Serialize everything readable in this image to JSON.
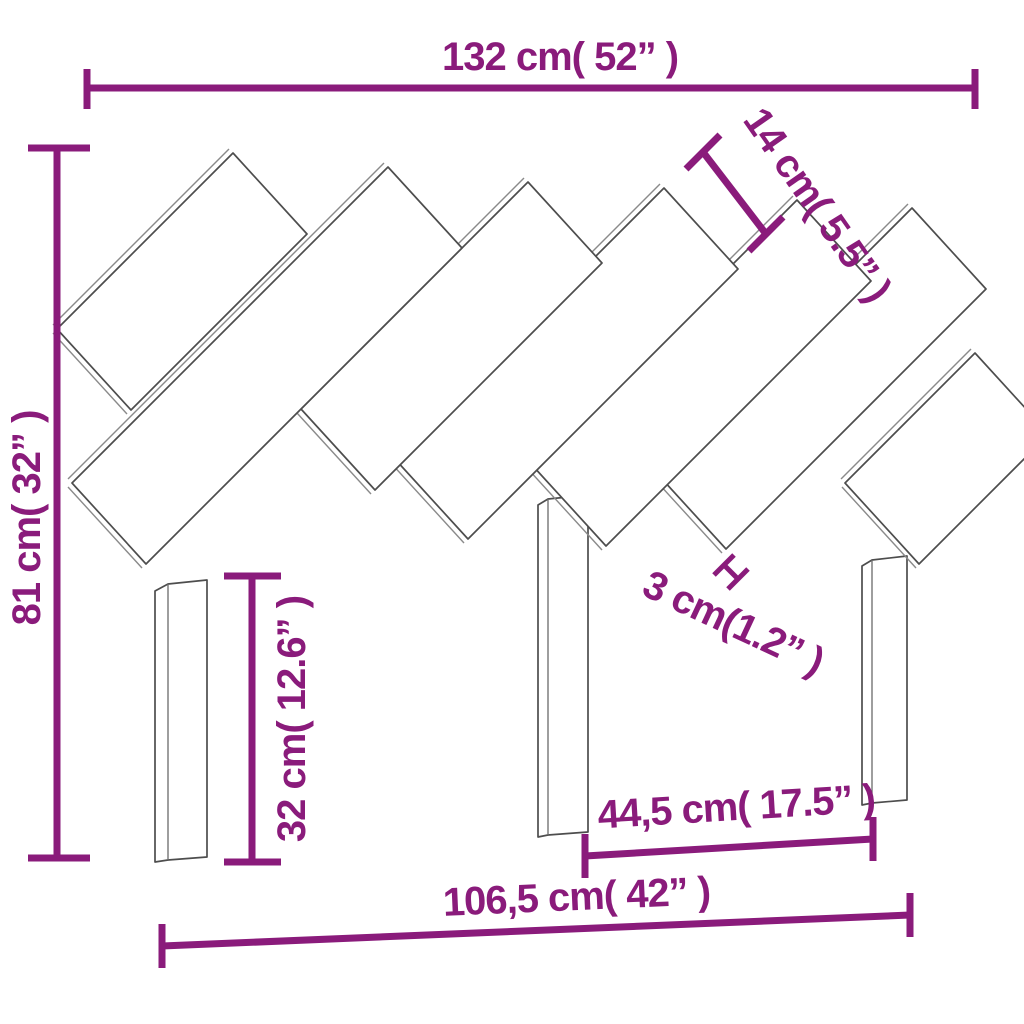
{
  "figure": {
    "kind": "furniture-dimension-diagram",
    "subject": "bed headboard with diagonal slats and three legs",
    "colors": {
      "dimension_lines": "#8A1B7B",
      "line_art": "#4d4d4d",
      "background": "#ffffff"
    },
    "dimensions": [
      {
        "id": "total_width",
        "label": "132 cm( 52” )",
        "cm": 132,
        "inches": 52,
        "placement": "horizontal-top"
      },
      {
        "id": "slat_width",
        "label": "14 cm( 5.5” )",
        "cm": 14,
        "inches": 5.5,
        "placement": "diagonal-upper-right"
      },
      {
        "id": "total_height",
        "label": "81 cm( 32” )",
        "cm": 81,
        "inches": 32,
        "placement": "vertical-left"
      },
      {
        "id": "leg_height",
        "label": "32 cm( 12.6” )",
        "cm": 32,
        "inches": 12.6,
        "placement": "vertical-inner-left"
      },
      {
        "id": "slat_gap",
        "label": "3 cm(1.2” )",
        "cm": 3,
        "inches": 1.2,
        "placement": "diagonal-middle"
      },
      {
        "id": "inner_leg_span",
        "label": "44,5 cm( 17.5” )",
        "cm": 44.5,
        "inches": 17.5,
        "placement": "horizontal-inner-bottom"
      },
      {
        "id": "base_width",
        "label": "106,5 cm( 42” )",
        "cm": 106.5,
        "inches": 42,
        "placement": "horizontal-bottom"
      }
    ]
  }
}
